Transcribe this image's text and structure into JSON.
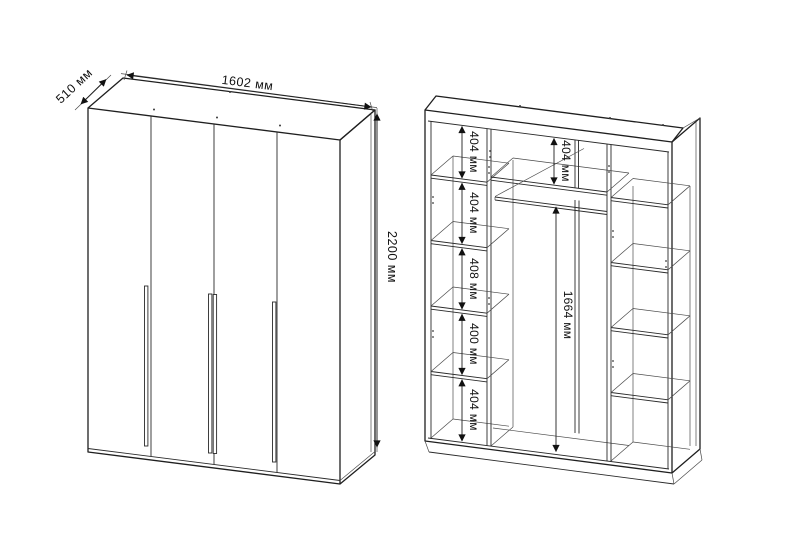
{
  "drawing": {
    "background": "#ffffff",
    "line_color": "#1f1f1f",
    "front_view": {
      "width_label": "1602 мм",
      "depth_label": "510 мм",
      "height_label": "2200 мм",
      "door_count": 4
    },
    "interior_view": {
      "left_sections": [
        "404 мм",
        "404 мм",
        "408 мм",
        "400 мм",
        "404 мм"
      ],
      "top_middle_label": "404 мм",
      "hanging_label": "1664 мм"
    }
  }
}
